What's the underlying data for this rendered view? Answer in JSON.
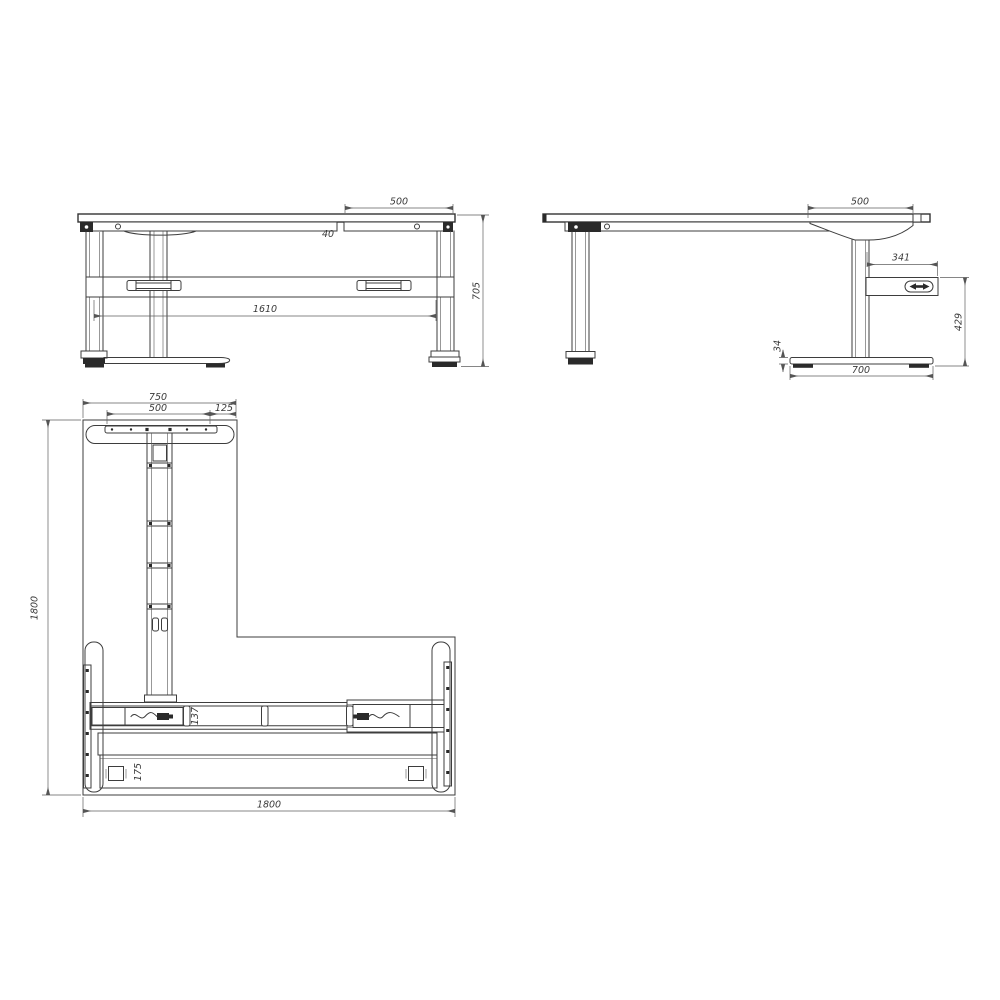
{
  "drawing": {
    "kind": "l-shaped height adjustable desk frame - 3 view technical drawing",
    "colors": {
      "background": "#ffffff",
      "line": "#3d3d3d",
      "dimension": "#5f5f5f",
      "dark_fill": "#2a2a2a"
    },
    "icons": {
      "controller_icon": "up-down-adjust-arrows"
    },
    "views": {
      "front": {
        "dims": {
          "overhang": "500",
          "rail_gap": "40",
          "leg_spacing": "1610",
          "frame_height": "705"
        }
      },
      "side": {
        "dims": {
          "overhang": "500",
          "controller_length": "341",
          "controller_to_floor": "429",
          "foot_height": "34",
          "foot_length": "700"
        }
      },
      "plan": {
        "dims": {
          "arm_width": "750",
          "plate_length": "500",
          "edge_margin": "125",
          "arm_depth": "1800",
          "overall_width": "1800",
          "beam_width": "137",
          "tray_width": "175"
        }
      }
    }
  }
}
